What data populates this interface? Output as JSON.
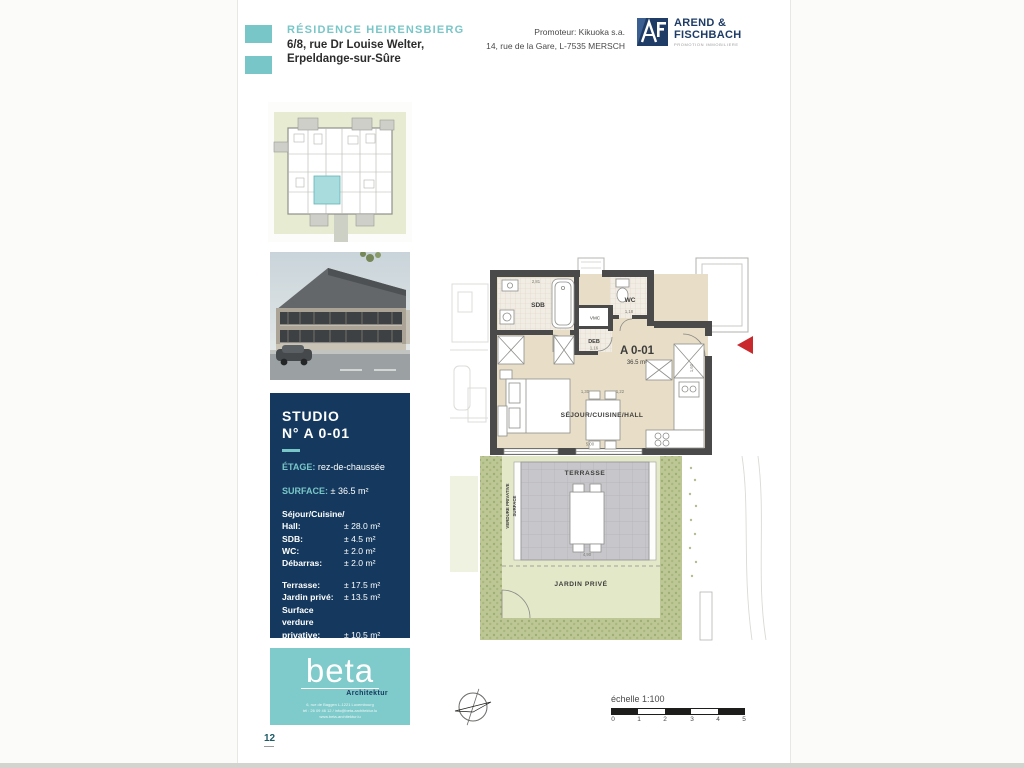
{
  "header": {
    "residence": "RÉSIDENCE HEIRENSBIERG",
    "address_line1": "6/8, rue Dr Louise Welter,",
    "address_line2": "Erpeldange-sur-Sûre",
    "promoter_line1": "Promoteur: Kikuoka s.a.",
    "promoter_line2": "14, rue de la Gare, L-7535 MERSCH",
    "logo": {
      "name_line1": "AREND &",
      "name_line2": "FISCHBACH",
      "tagline": "PROMOTION IMMOBILIERE"
    }
  },
  "info_box": {
    "title_line1": "STUDIO",
    "title_line2": "N° A 0-01",
    "etage_label": "ÉTAGE:",
    "etage_value": "rez-de-chaussée",
    "surface_label": "SURFACE:",
    "surface_value": "± 36.5 m²",
    "rooms": [
      {
        "label": "Séjour/Cuisine/",
        "label2": "Hall:",
        "value": "± 28.0 m²"
      },
      {
        "label": "SDB:",
        "value": "± 4.5 m²"
      },
      {
        "label": "WC:",
        "value": "± 2.0 m²"
      },
      {
        "label": "Débarras:",
        "value": "± 2.0 m²"
      }
    ],
    "outdoor": [
      {
        "label": "Terrasse:",
        "value": "± 17.5 m²"
      },
      {
        "label": "Jardin privé:",
        "value": "± 13.5 m²"
      },
      {
        "label": "Surface verdure",
        "label2": "privative:",
        "value": "± 10.5 m²"
      }
    ]
  },
  "beta": {
    "name": "beta",
    "subtitle": "Architektur",
    "line1": "6, rue de Baggen L-1221 Luxembourg",
    "line2": "tél : 26 09 46 12 / info@beta-architektur.lu",
    "line3": "www.beta-architektur.lu"
  },
  "plan": {
    "unit_label": "A 0-01",
    "unit_area": "36.5 m²",
    "room_sdb": "SDB",
    "room_wc": "WC",
    "room_vmc": "VMC",
    "room_deb": "DEB",
    "room_sejour": "SÉJOUR/CUISINE/HALL",
    "terrasse": "TERRASSE",
    "jardin": "JARDIN PRIVÉ",
    "verdure_line1": "SURFACE",
    "verdure_line2": "VERDURE PRIVATIVE",
    "dims": {
      "sdb": "2,81",
      "wc": "1,18",
      "deb": "1,16",
      "hall_left": "1,30",
      "hall_right": "1,22",
      "room": "5,00",
      "door": "1,60",
      "terrace": "4,90"
    }
  },
  "scale": {
    "label": "échelle 1:100",
    "ticks": [
      "0",
      "1",
      "2",
      "3",
      "4",
      "5"
    ]
  },
  "page": {
    "number": "12"
  },
  "colors": {
    "teal": "#79c6c8",
    "navy": "#15395e",
    "wall": "#4a4a4a",
    "floor": "#e8ddc7",
    "tile": "#f1ece4",
    "terrace": "#c7c6ca",
    "garden": "#e3e8c8",
    "hedge": "#bcc795",
    "red": "#c9282c"
  }
}
